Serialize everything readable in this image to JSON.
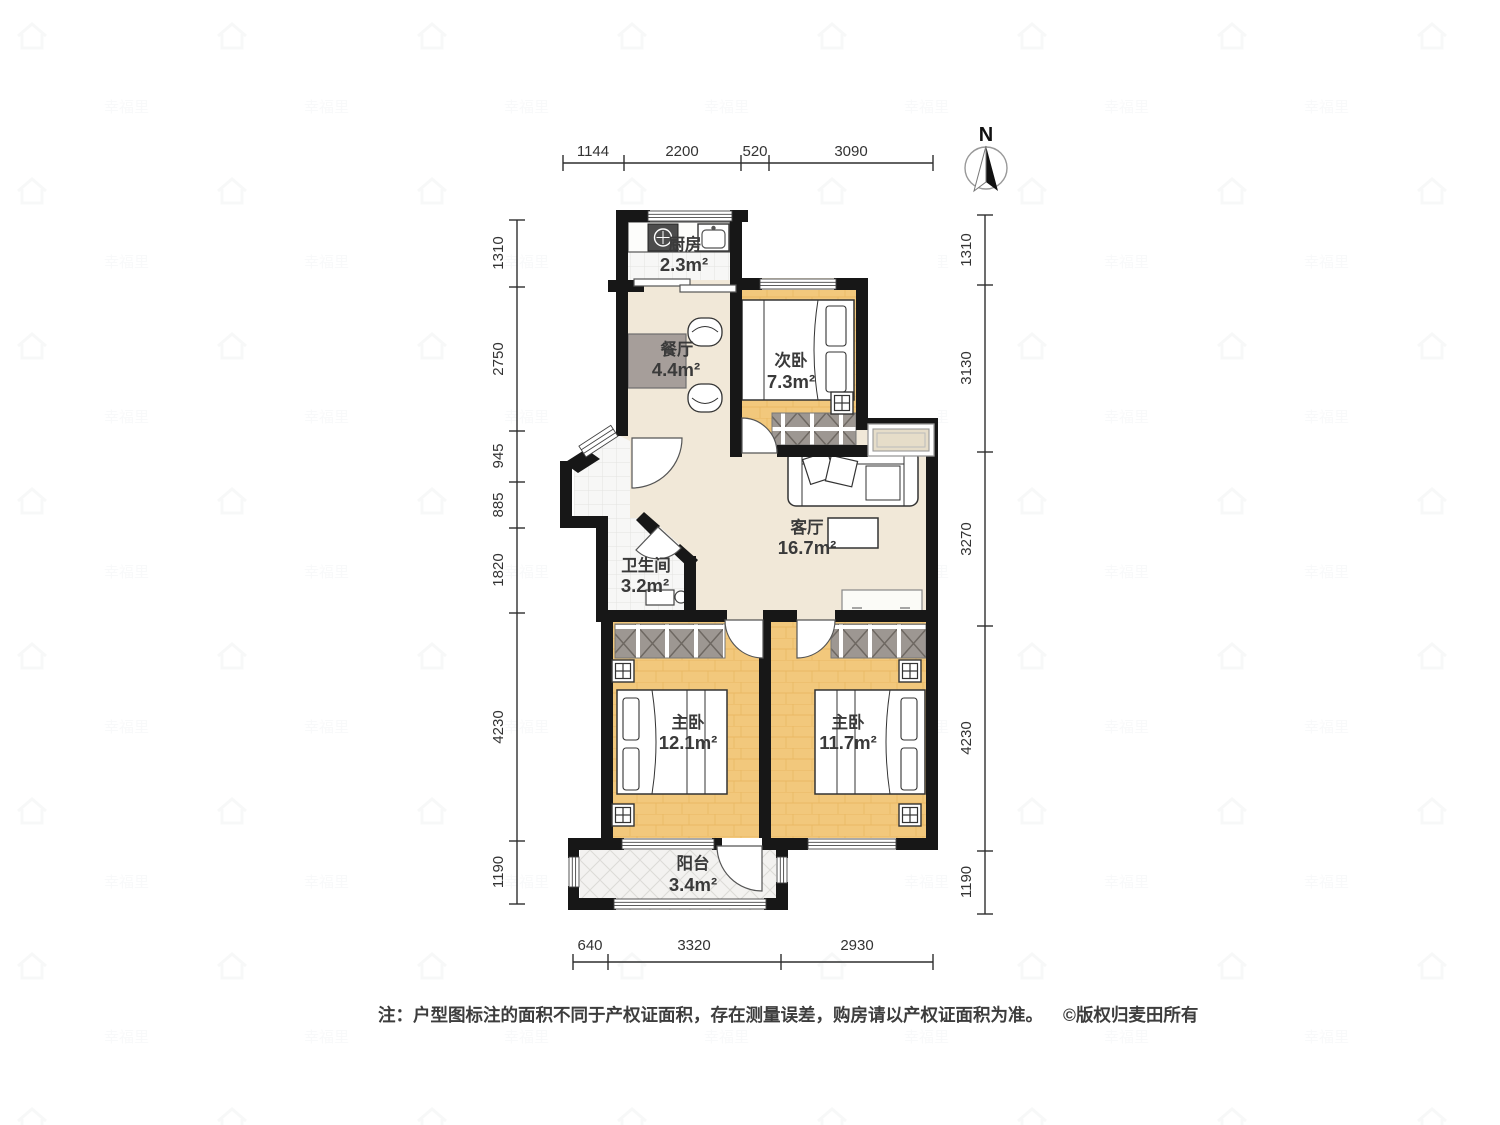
{
  "compass": {
    "label": "N"
  },
  "watermark": {
    "text": "幸福里"
  },
  "rooms": {
    "kitchen": {
      "name": "厨房",
      "area": "2.3m²"
    },
    "dining": {
      "name": "餐厅",
      "area": "4.4m²"
    },
    "bedroom2": {
      "name": "次卧",
      "area": "7.3m²"
    },
    "living": {
      "name": "客厅",
      "area": "16.7m²"
    },
    "bathroom": {
      "name": "卫生间",
      "area": "3.2m²"
    },
    "master_left": {
      "name": "主卧",
      "area": "12.1m²"
    },
    "master_right": {
      "name": "主卧",
      "area": "11.7m²"
    },
    "balcony": {
      "name": "阳台",
      "area": "3.4m²"
    }
  },
  "dimensions": {
    "top": [
      "1144",
      "2200",
      "520",
      "3090"
    ],
    "left": [
      "1310",
      "2750",
      "945",
      "885",
      "1820",
      "4230",
      "1190"
    ],
    "right": [
      "1310",
      "3130",
      "3270",
      "4230",
      "1190"
    ],
    "bottom": [
      "640",
      "3320",
      "2930"
    ]
  },
  "footer": {
    "note": "注：户型图标注的面积不同于产权证面积，存在测量误差，购房请以产权证面积为准。",
    "copyright": "©版权归麦田所有"
  },
  "colors": {
    "wall": "#171717",
    "floor_wood": "#f2c87c",
    "floor_beige": "#f1e8d8",
    "floor_tile": "#f7f7f6",
    "wardrobe_gray": "#9d9792",
    "bay_fill": "#e6ddc9",
    "text": "#3a3a3a"
  }
}
